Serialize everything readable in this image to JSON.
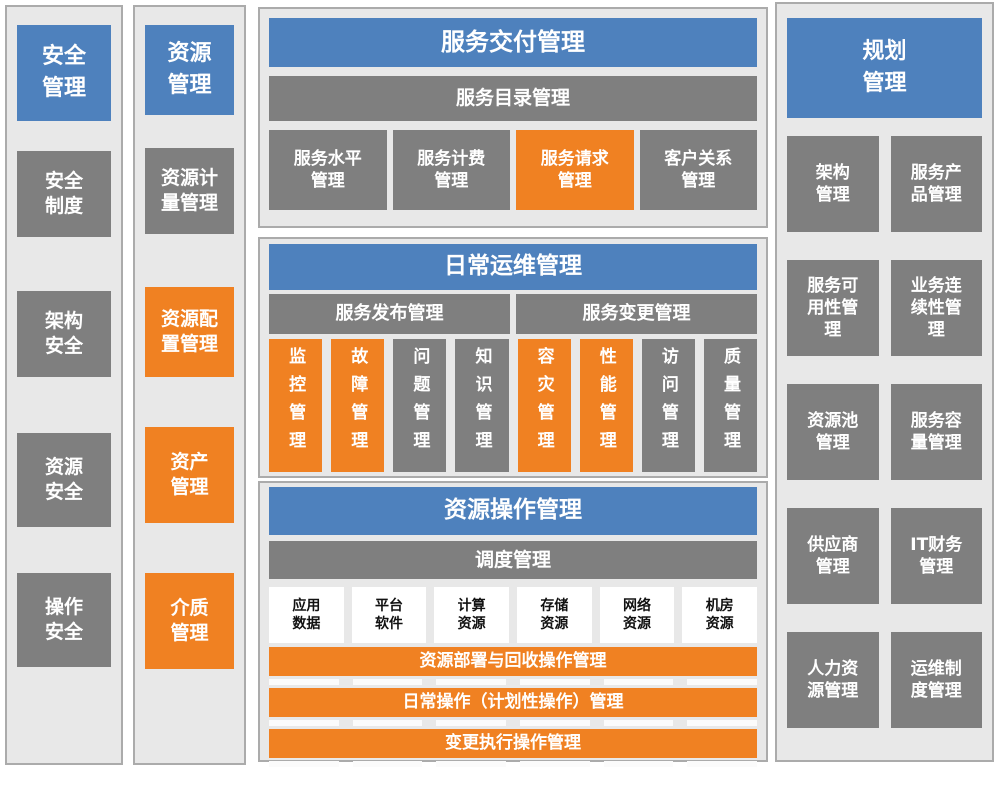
{
  "colors": {
    "blue": "#4E81BD",
    "gray": "#7F7F7F",
    "orange": "#F08122",
    "panel_bg": "#E8E8E8",
    "panel_border": "#ABABAB",
    "sep": "#FBFBFB"
  },
  "security": {
    "header": "安全\n管理",
    "items": [
      {
        "label": "安全\n制度",
        "variant": "gray"
      },
      {
        "label": "架构\n安全",
        "variant": "gray"
      },
      {
        "label": "资源\n安全",
        "variant": "gray"
      },
      {
        "label": "操作\n安全",
        "variant": "gray"
      }
    ]
  },
  "resource": {
    "header": "资源\n管理",
    "items": [
      {
        "label": "资源计\n量管理",
        "variant": "gray"
      },
      {
        "label": "资源配\n置管理",
        "variant": "orange"
      },
      {
        "label": "资产\n管理",
        "variant": "orange"
      },
      {
        "label": "介质\n管理",
        "variant": "orange"
      }
    ]
  },
  "service_delivery": {
    "header": "服务交付管理",
    "catalog_bar": "服务目录管理",
    "items": [
      {
        "label": "服务水平\n管理",
        "variant": "gray"
      },
      {
        "label": "服务计费\n管理",
        "variant": "gray"
      },
      {
        "label": "服务请求\n管理",
        "variant": "orange"
      },
      {
        "label": "客户关系\n管理",
        "variant": "gray"
      }
    ]
  },
  "daily_ops": {
    "header": "日常运维管理",
    "bars": [
      {
        "label": "服务发布管理"
      },
      {
        "label": "服务变更管理"
      }
    ],
    "items": [
      {
        "label": "监控管理",
        "variant": "orange"
      },
      {
        "label": "故障管理",
        "variant": "orange"
      },
      {
        "label": "问题管理",
        "variant": "gray"
      },
      {
        "label": "知识管理",
        "variant": "gray"
      },
      {
        "label": "容灾管理",
        "variant": "orange"
      },
      {
        "label": "性能管理",
        "variant": "orange"
      },
      {
        "label": "访问管理",
        "variant": "gray"
      },
      {
        "label": "质量管理",
        "variant": "gray"
      }
    ]
  },
  "resource_ops": {
    "header": "资源操作管理",
    "scheduling_bar": "调度管理",
    "resources": [
      {
        "label": "应用\n数据"
      },
      {
        "label": "平台\n软件"
      },
      {
        "label": "计算\n资源"
      },
      {
        "label": "存储\n资源"
      },
      {
        "label": "网络\n资源"
      },
      {
        "label": "机房\n资源"
      }
    ],
    "ops_bars": [
      {
        "label": "资源部署与回收操作管理"
      },
      {
        "label": "日常操作（计划性操作）管理"
      },
      {
        "label": "变更执行操作管理"
      }
    ]
  },
  "planning": {
    "header": "规划\n管理",
    "items": [
      {
        "label": "架构\n管理"
      },
      {
        "label": "服务产\n品管理"
      },
      {
        "label": "服务可\n用性管\n理"
      },
      {
        "label": "业务连\n续性管\n理"
      },
      {
        "label": "资源池\n管理"
      },
      {
        "label": "服务容\n量管理"
      },
      {
        "label": "供应商\n管理"
      },
      {
        "label": "IT财务\n管理"
      },
      {
        "label": "人力资\n源管理"
      },
      {
        "label": "运维制\n度管理"
      }
    ]
  }
}
